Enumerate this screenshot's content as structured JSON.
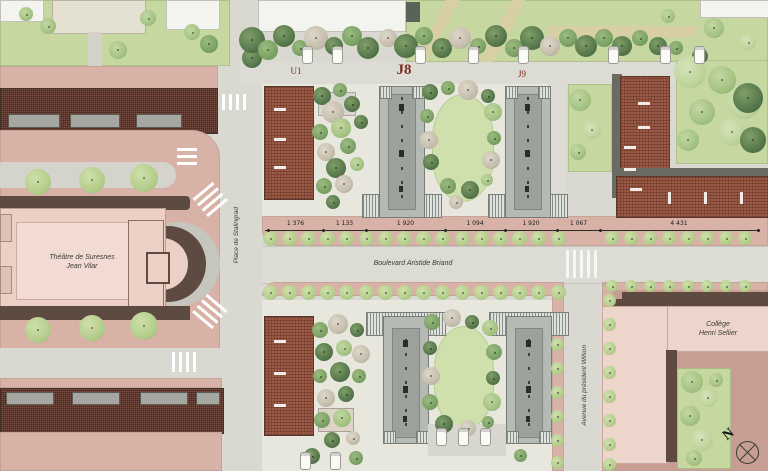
{
  "map": {
    "labels": {
      "theatre_line1": "Théâtre de Suresnes",
      "theatre_line2": "Jean Vilar",
      "college_line1": "Collège",
      "college_line2": "Henri Sellier",
      "boulevard": "Boulevard Aristide Briand",
      "place": "Place de Stalingrad",
      "avenue": "Avenue du président Wilson",
      "block_u1": "U1",
      "block_j8": "J8",
      "block_j9": "J9",
      "north_letter": "N"
    },
    "dimensions": {
      "values": [
        "1 376",
        "1 133",
        "1 920",
        "1 094",
        "1 920",
        "1 067",
        "4 431"
      ]
    },
    "colors": {
      "road": "#dcdcd4",
      "sidewalk_pink": "#d8b2a6",
      "ground_mauve": "#c79e94",
      "lawn_green": "#c7d7a0",
      "building_pink": "#ecd0c6",
      "roof_red": "#9a5a46",
      "roof_dark": "#7a5044",
      "tower_gray": "#b6bab4",
      "outline_brown": "#5d4a40",
      "block_label_red": "#7c2d20"
    }
  }
}
